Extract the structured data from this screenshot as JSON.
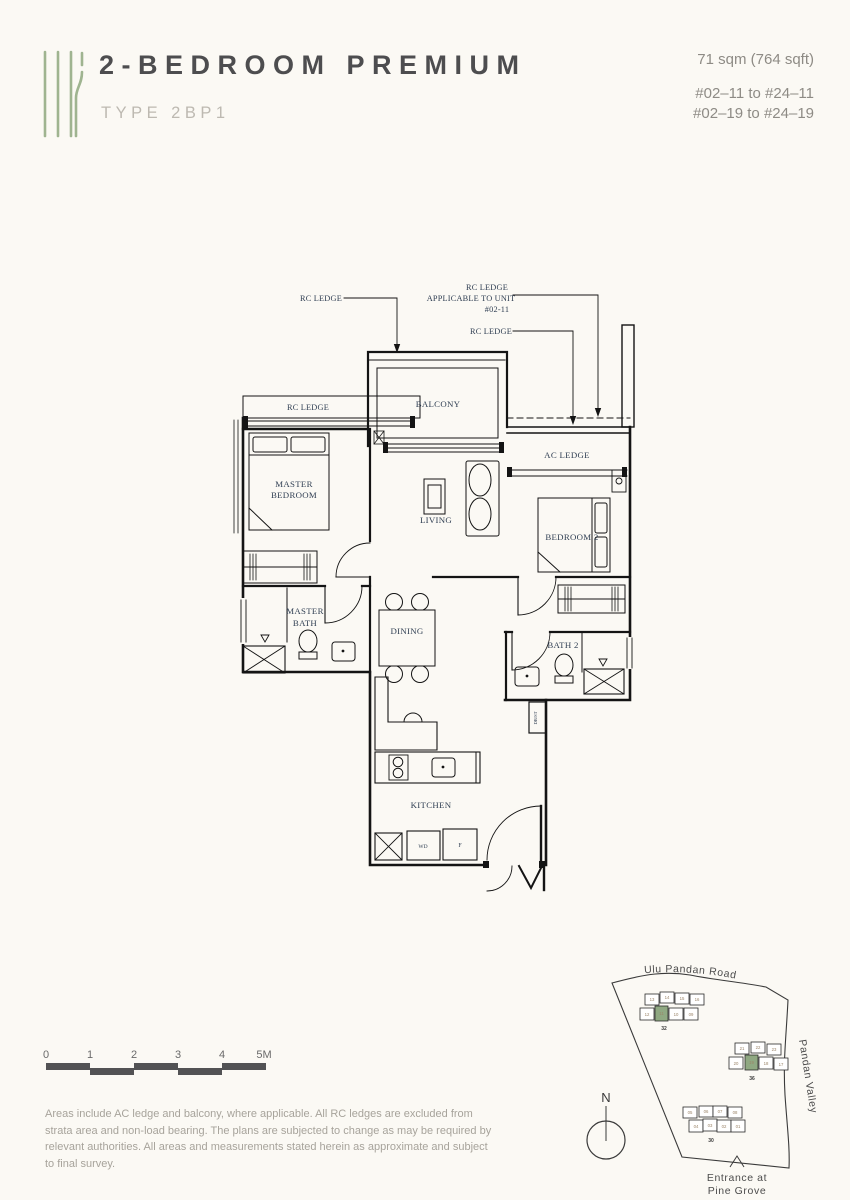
{
  "header": {
    "title": "2-BEDROOM PREMIUM",
    "type": "TYPE 2BP1",
    "area": "71 sqm (764 sqft)",
    "units_line1": "#02–11 to #24–11",
    "units_line2": "#02–19 to #24–19"
  },
  "plan": {
    "leaders": {
      "rc_ledge_left": "RC LEDGE",
      "rc_unit_line1": "RC LEDGE",
      "rc_unit_line2": "APPLICABLE TO UNIT",
      "rc_unit_line3": "#02-11",
      "rc_ledge_right": "RC LEDGE",
      "rc_ledge_strip": "RC LEDGE"
    },
    "rooms": {
      "balcony": "BALCONY",
      "ac_ledge": "AC LEDGE",
      "master_bedroom_line1": "MASTER",
      "master_bedroom_line2": "BEDROOM",
      "living": "LIVING",
      "bedroom2": "BEDROOM 2",
      "master_bath_line1": "MASTER",
      "master_bath_line2": "BATH",
      "dining": "DINING",
      "bath2": "BATH 2",
      "kitchen": "KITCHEN",
      "wd": "WD",
      "f": "F",
      "dbst": "DB/ST"
    }
  },
  "scale_bar": {
    "labels": [
      "0",
      "1",
      "2",
      "3",
      "4",
      "5M"
    ]
  },
  "site_map": {
    "north": "N",
    "road_top": "Ulu Pandan Road",
    "road_right": "Pandan Valley",
    "entrance_line1": "Entrance at",
    "entrance_line2": "Pine Grove",
    "clusters": [
      {
        "block": "32",
        "units_top": [
          "13",
          "14",
          "15",
          "16"
        ],
        "units_bottom": [
          "12",
          "11",
          "10",
          "09"
        ],
        "highlighted": "11"
      },
      {
        "block": "36",
        "units_top": [
          "21",
          "22",
          "23"
        ],
        "units_bottom": [
          "20",
          "19",
          "18",
          "17"
        ],
        "highlighted": "19"
      },
      {
        "block": "30",
        "units_top": [
          "05",
          "06",
          "07",
          "08"
        ],
        "units_bottom": [
          "04",
          "03",
          "02",
          "01"
        ],
        "highlighted": ""
      }
    ]
  },
  "disclaimer": "Areas include AC ledge and balcony, where applicable. All RC ledges are excluded from strata area and non-load bearing. The plans are subjected to change as may be required by relevant authorities. All areas and measurements stated herein as approximate and subject to final survey.",
  "colors": {
    "accent_green": "#9fb490",
    "highlight_green": "#8fa882",
    "title_gray": "#4d4d4f",
    "muted_gray": "#bdb9b1",
    "plan_label_navy": "#2f3e52"
  }
}
